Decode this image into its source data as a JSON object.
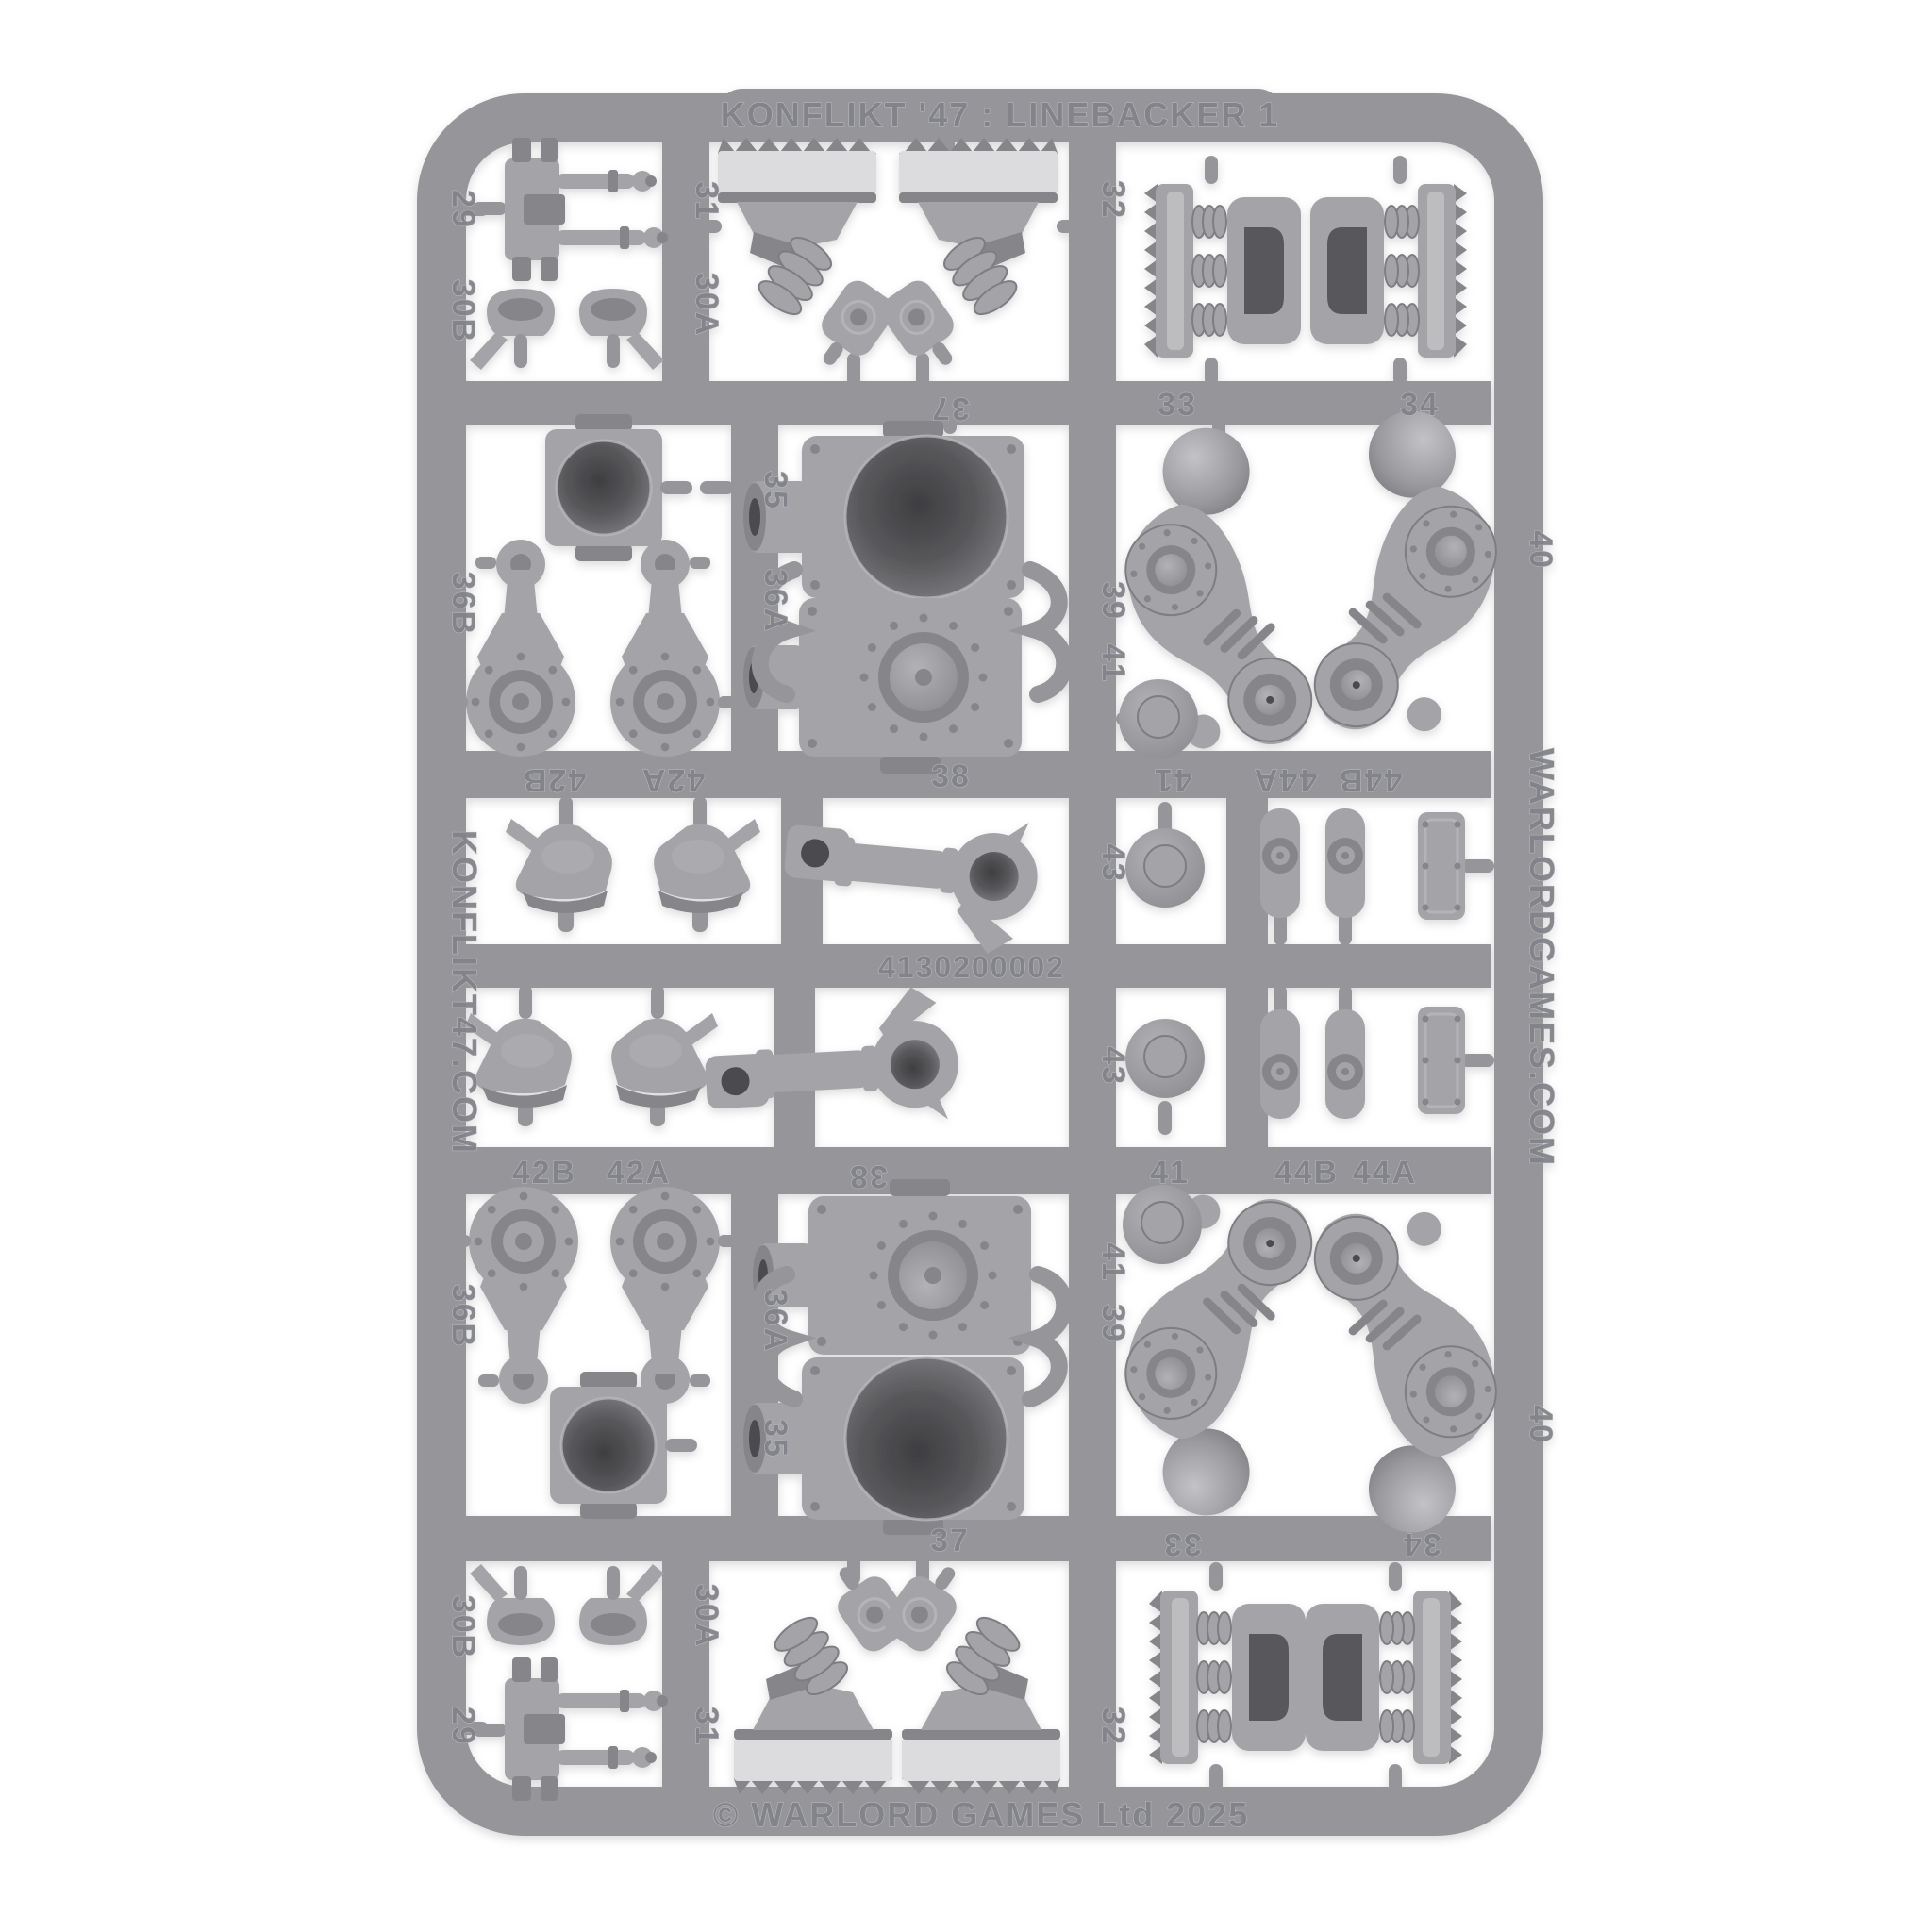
{
  "image_type": "product-photo of a plastic model kit sprue on white background",
  "product": {
    "title": "KONFLIKT '47 : LINEBACKER 1",
    "mould_code": "4130200002",
    "copyright": "© WARLORD GAMES Ltd 2025",
    "website_left_rail": "KONFLIKT47.COM",
    "website_right_rail": "WARLORDGAMES.COM"
  },
  "part_numbers": {
    "p29": "29",
    "p30a": "30A",
    "p30b": "30B",
    "p31": "31",
    "p32": "32",
    "p33": "33",
    "p34": "34",
    "p35": "35",
    "p36a": "36A",
    "p36b": "36B",
    "p37": "37",
    "p38": "38",
    "p39": "39",
    "p40": "40",
    "p41": "41",
    "p42a": "42A",
    "p42b": "42B",
    "p43": "43",
    "p44a": "44A",
    "p44b": "44B"
  },
  "parts": [
    {
      "number": "29",
      "shape": "pin-bracket",
      "copies": 2
    },
    {
      "number": "30A",
      "shape": "hook-clip",
      "copies": 2
    },
    {
      "number": "30B",
      "shape": "hook-clip",
      "copies": 2
    },
    {
      "number": "31",
      "shape": "treaded-foot",
      "copies": 2
    },
    {
      "number": "32",
      "shape": "treaded-foot",
      "copies": 2
    },
    {
      "number": "33",
      "shape": "track-pad-with-springs",
      "copies": 2
    },
    {
      "number": "34",
      "shape": "track-pad-with-springs",
      "copies": 2
    },
    {
      "number": "35",
      "shape": "domed-socket-block",
      "copies": 2
    },
    {
      "number": "36A",
      "shape": "crank-arm-with-gear-disc",
      "copies": 2
    },
    {
      "number": "36B",
      "shape": "crank-arm-with-gear-disc",
      "copies": 2
    },
    {
      "number": "37",
      "shape": "torso-socket-plate",
      "copies": 2
    },
    {
      "number": "38",
      "shape": "ringed-joint-plate",
      "copies": 2
    },
    {
      "number": "39",
      "shape": "wishbone-yoke",
      "copies": 2
    },
    {
      "number": "40",
      "shape": "leg-thigh-with-ball-joint",
      "copies": 4
    },
    {
      "number": "41",
      "shape": "round-disc",
      "copies": 4
    },
    {
      "number": "42A",
      "shape": "helmet",
      "copies": 2
    },
    {
      "number": "42B",
      "shape": "helmet",
      "copies": 2
    },
    {
      "number": "43",
      "shape": "piston-arm-with-ring",
      "copies": 2
    },
    {
      "number": "44A",
      "shape": "small-ringed-knob",
      "copies": 2
    },
    {
      "number": "44B",
      "shape": "small-ringed-knob",
      "copies": 2
    }
  ],
  "colors": {
    "background": "#ffffff",
    "sprue": "#96969a",
    "part": "#a4a4a8",
    "part_dark": "#86868a",
    "recess": "#4c4c4f",
    "highlight": "#dcdcde",
    "emboss": "#82828a",
    "emboss_hl": "#c1c1c6"
  }
}
